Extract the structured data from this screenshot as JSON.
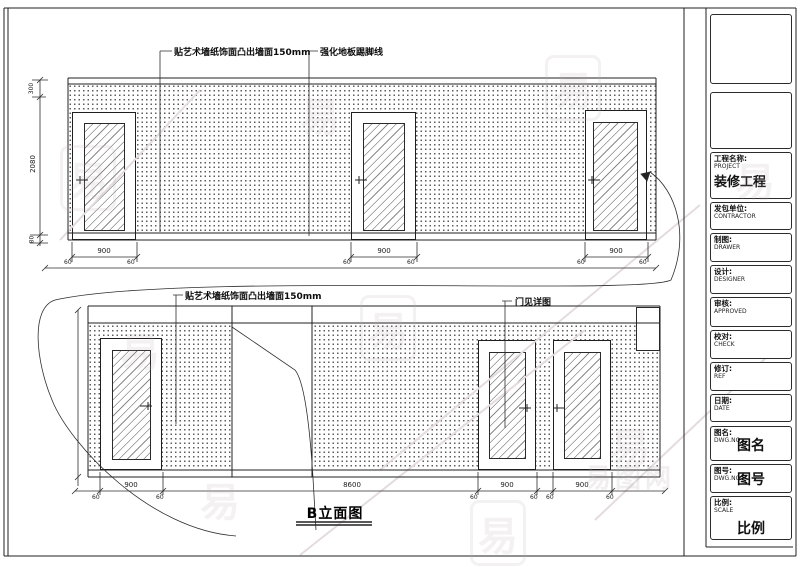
{
  "drawing_title": "B立面图",
  "annotations": {
    "wallpaper_note_top": "贴艺术墙纸饰面凸出墙面150mm",
    "skirting_note": "强化地板踢脚线",
    "wallpaper_note_bottom": "贴艺术墙纸饰面凸出墙面150mm",
    "door_detail_note": "门见详图"
  },
  "dims": {
    "door_width": "900",
    "offset": "60",
    "total_width_bottom": "8600",
    "wall_height": "2080",
    "top_margin": "300",
    "skirting_height": "80"
  },
  "title_block": {
    "rows": [
      {
        "label": "工程名称:",
        "en": "PROJECT",
        "value": "装修工程"
      },
      {
        "label": "发包单位:",
        "en": "CONTRACTOR",
        "value": ""
      },
      {
        "label": "制图:",
        "en": "DRAWER",
        "value": ""
      },
      {
        "label": "设计:",
        "en": "DESIGNER",
        "value": ""
      },
      {
        "label": "审核:",
        "en": "APPROVED",
        "value": ""
      },
      {
        "label": "校对:",
        "en": "CHECK",
        "value": ""
      },
      {
        "label": "修订:",
        "en": "REF",
        "value": ""
      },
      {
        "label": "日期:",
        "en": "DATE",
        "value": ""
      },
      {
        "label": "图名:",
        "en": "DWG.NO",
        "value": "图名"
      },
      {
        "label": "图号:",
        "en": "DWG.NO",
        "value": "图号"
      },
      {
        "label": "比例:",
        "en": "SCALE",
        "value": "比例"
      }
    ]
  },
  "watermark": {
    "char": "易",
    "site_text": "易图网"
  }
}
